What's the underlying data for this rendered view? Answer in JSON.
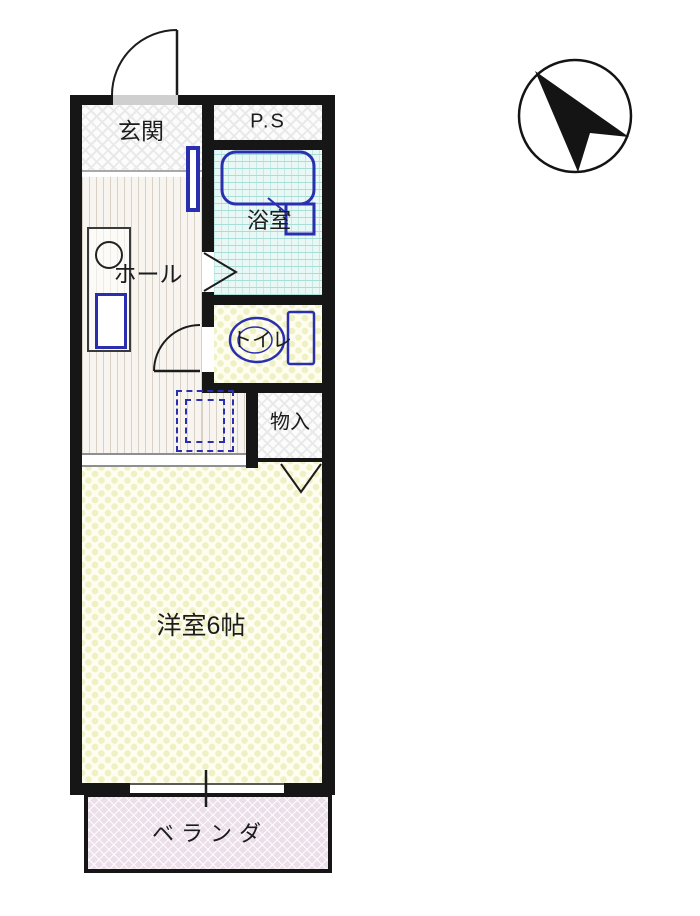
{
  "floor_plan": {
    "rooms": {
      "genkan": {
        "label": "玄関"
      },
      "pipe_space": {
        "label": "P.S"
      },
      "bathroom": {
        "label": "浴室"
      },
      "hall": {
        "label": "ホール"
      },
      "toilet": {
        "label": "トイレ"
      },
      "storage": {
        "label": "物入"
      },
      "western_room": {
        "label": "洋室6帖",
        "size_tatami": 6
      },
      "veranda": {
        "label": "ベランダ"
      }
    },
    "fixtures": [
      "bathtub",
      "toilet-bowl-and-tank",
      "mini-kitchen-with-burner-and-sink",
      "washing-machine-space-dashed",
      "entrance-swing-door",
      "toilet-swing-door",
      "bathroom-door-marker",
      "storage-folding-door-marker",
      "hall-room-sliding-door",
      "veranda-sliding-window",
      "compass-north-arrow"
    ],
    "compass": {
      "arrow_direction": "north-west"
    }
  },
  "colors": {
    "wall": "#161616",
    "fixture-blue": "#2a2fb0",
    "text": "#1c1c1c",
    "bath-bg": "#e9f7f5",
    "bath-line": "#a8ddd8",
    "room-bg": "#fffdf0",
    "room-dot": "#eef1c4",
    "veranda-bg": "#ecdfe9",
    "stripe-bg": "#f8f5f0",
    "stripe-line": "#d9d1c5",
    "checker": "#e9e9e9"
  }
}
